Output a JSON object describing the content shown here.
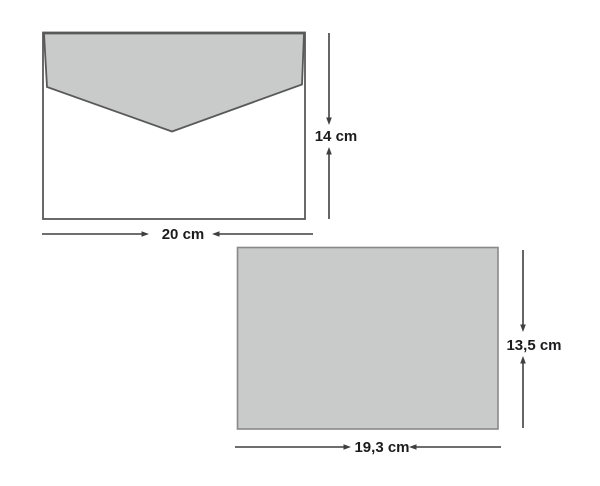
{
  "envelope": {
    "height_label": "14 cm",
    "width_label": "20 cm"
  },
  "card": {
    "height_label": "13,5 cm",
    "width_label": "19,3 cm"
  },
  "colors": {
    "background": "#ffffff",
    "shape_fill": "#c9caca",
    "envelope_body_fill": "#ffffff",
    "envelope_outline": "#59595b",
    "card_outline": "#88898b",
    "dimension_line": "#3e3f41",
    "label_text": "#1c1c1e"
  }
}
